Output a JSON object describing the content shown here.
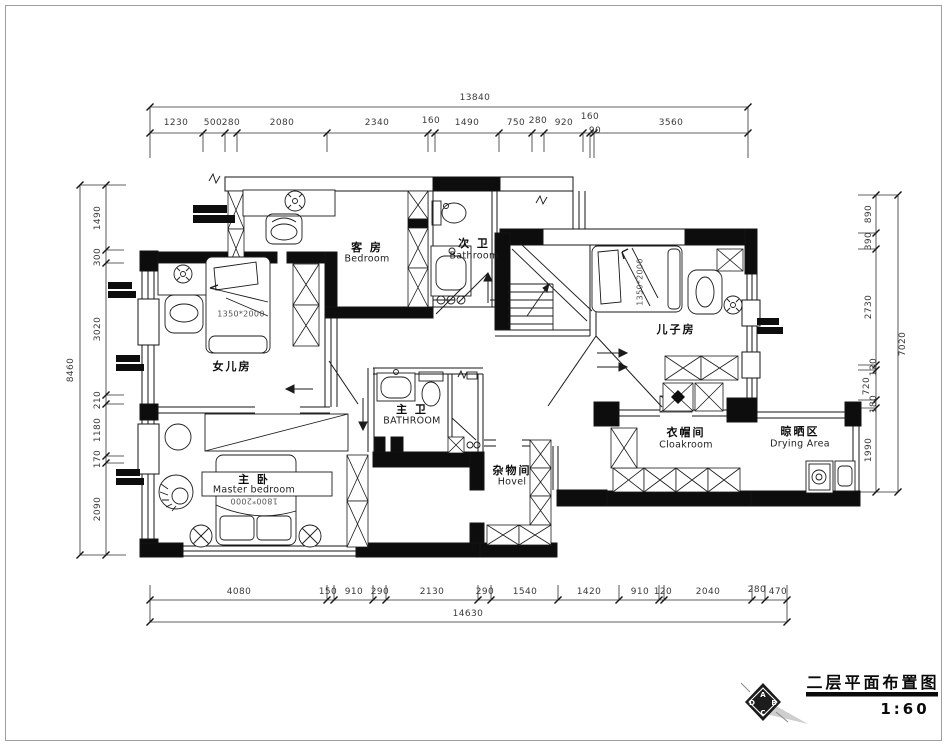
{
  "title_block": {
    "title": "二层平面布置图",
    "scale": "1:60",
    "logo": {
      "top": "A",
      "left": "D",
      "right": "B",
      "bottom": "C"
    }
  },
  "rooms": {
    "guest": {
      "cn": "客 房",
      "en": "Bedroom"
    },
    "bath2": {
      "cn": "次 卫",
      "en": "Bathroom"
    },
    "daughter": {
      "cn": "女儿房",
      "bed_size": "1350*2000"
    },
    "son": {
      "cn": "儿子房",
      "bed_size": "1350*2000"
    },
    "mbath": {
      "cn": "主 卫",
      "en": "BATHROOM"
    },
    "master": {
      "cn": "主 卧",
      "en": "Master bedroom",
      "bed_size": "1800*2000"
    },
    "hovel": {
      "cn": "杂物间",
      "en": "Hovel"
    },
    "cloak": {
      "cn": "衣帽间",
      "en": "Cloakroom"
    },
    "drying": {
      "cn": "晾晒区",
      "en": "Drying Area"
    }
  },
  "dims": {
    "top": {
      "total": "13840",
      "segs": [
        "1230",
        "500",
        "280",
        "2080",
        "2340",
        "160",
        "1490",
        "750",
        "280",
        "920",
        "160",
        "90",
        "3560"
      ]
    },
    "bottom": {
      "total": "14630",
      "segs": [
        "4080",
        "150",
        "910",
        "290",
        "2130",
        "290",
        "1540",
        "1420",
        "910",
        "120",
        "2040",
        "280",
        "470"
      ]
    },
    "left": {
      "total": "8460",
      "segs": [
        "1490",
        "300",
        "3020",
        "210",
        "1180",
        "170",
        "2090"
      ]
    },
    "right": {
      "total": "7020",
      "segs": [
        "890",
        "390",
        "2730",
        "120",
        "720",
        "180",
        "1990"
      ]
    }
  }
}
